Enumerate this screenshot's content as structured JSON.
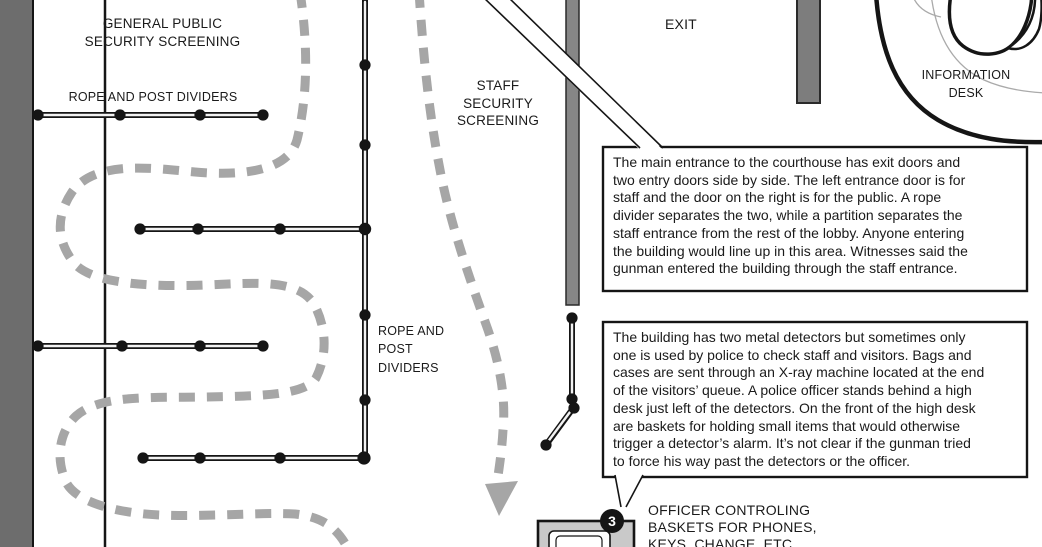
{
  "labels": {
    "general_public": "GENERAL PUBLIC\nSECURITY SCREENING",
    "rope_dividers_top": "ROPE AND POST DIVIDERS",
    "staff_screening": "STAFF\nSECURITY\nSCREENING",
    "exit": "EXIT",
    "information_desk": "INFORMATION\nDESK",
    "rope_dividers_left": "ROPE AND\nPOST\nDIVIDERS",
    "officer_baskets": "OFFICER CONTROLING\nBASKETS FOR PHONES,\nKEYS, CHANGE, ETC.",
    "badge_3": "3"
  },
  "callouts": {
    "main_entrance": "The main entrance to the courthouse has exit doors and\ntwo entry doors side by side. The left entrance door is for\nstaff and the door on the right is for the public. A rope\ndivider separates the two, while a partition separates the\nstaff entrance from the rest of the lobby. Anyone entering\nthe building would line up in this area. Witnesses said the\ngunman entered the building through the staff entrance.",
    "metal_detectors": "The building has two metal detectors but sometimes only\none is used by police to check staff and visitors. Bags and\ncases are sent through an X-ray machine located at the end\nof the visitors’ queue. A police officer stands behind a high\ndesk just left of the detectors. On the front of the high desk\nare baskets for holding small items that would otherwise\ntrigger a detector’s alarm. It’s not clear if the gunman tried\nto force his way past the detectors or the officer."
  },
  "colors": {
    "ink": "#151515",
    "wall_dark": "#6d6d6d",
    "wall_mid": "#7d7d7d",
    "partition": "#868686",
    "queue_path": "#a6a6a6",
    "xray_fill": "#c9c9c9"
  }
}
